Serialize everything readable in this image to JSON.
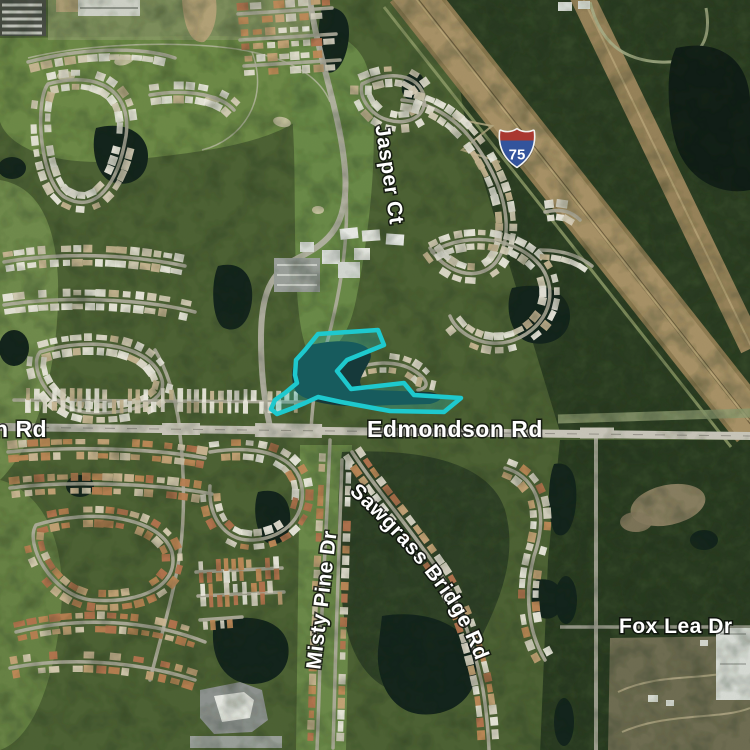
{
  "map": {
    "view": "satellite",
    "road_labels": {
      "left_partial": "n Rd",
      "edmondson": "Edmondson Rd",
      "jasper": "Jasper Ct",
      "misty_pine": "Misty Pine Dr",
      "sawgrass_bridge": "Sawgrass Bridge Rd",
      "fox_lea": "Fox Lea Dr"
    },
    "highway_shield": {
      "system": "Interstate",
      "number": "75",
      "red": "#a93830",
      "blue": "#33549c"
    },
    "selection": {
      "stroke": "#1EC9CE",
      "fill": "#1EC9CE",
      "fill_opacity": "0.24"
    }
  }
}
